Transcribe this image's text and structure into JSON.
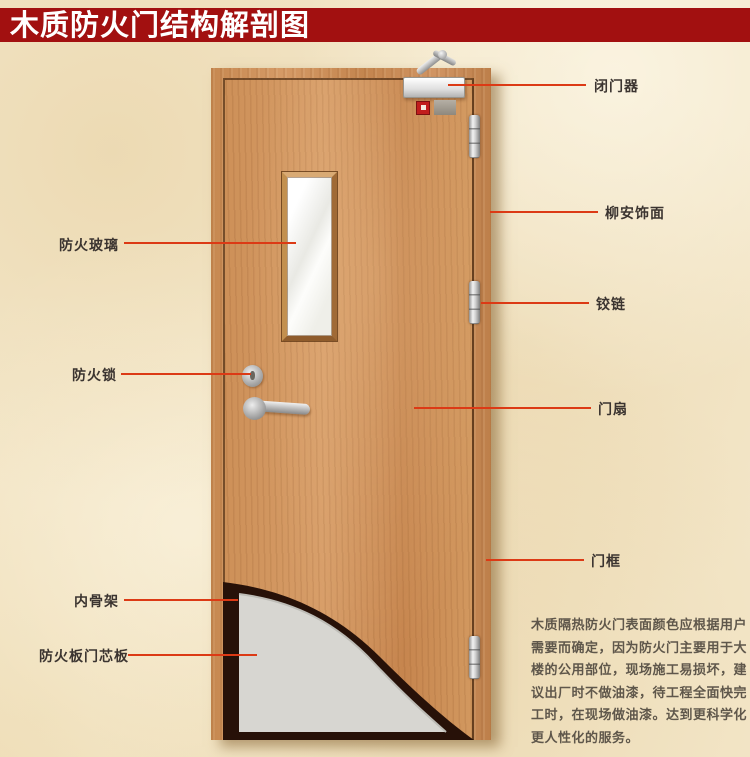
{
  "title": "木质防火门结构解剖图",
  "callouts": {
    "fire_glass": "防火玻璃",
    "fire_lock": "防火锁",
    "inner_skeleton": "内骨架",
    "fire_board_core": "防火板门芯板",
    "door_closer": "闭门器",
    "lauan_veneer": "柳安饰面",
    "hinge": "铰链",
    "door_leaf": "门扇",
    "door_frame": "门框"
  },
  "description": {
    "lines": [
      "木质隔热防火门表面颜色应根据用户",
      "需要而确定，因为防火门主要用于大",
      "楼的公用部位，现场施工易损坏，建",
      "议出厂时不做油漆，待工程全面快完",
      "工时，在现场做油漆。达到更科学化",
      "更人性化的服务。"
    ]
  },
  "colors": {
    "banner_red": "#a21010",
    "callout_line": "#dc3a15",
    "door_wood": "#cd9058",
    "core_panel_gray": "#d7d6d1",
    "skeleton_dark": "#271108",
    "background_parchment": "#f3e6c8"
  }
}
